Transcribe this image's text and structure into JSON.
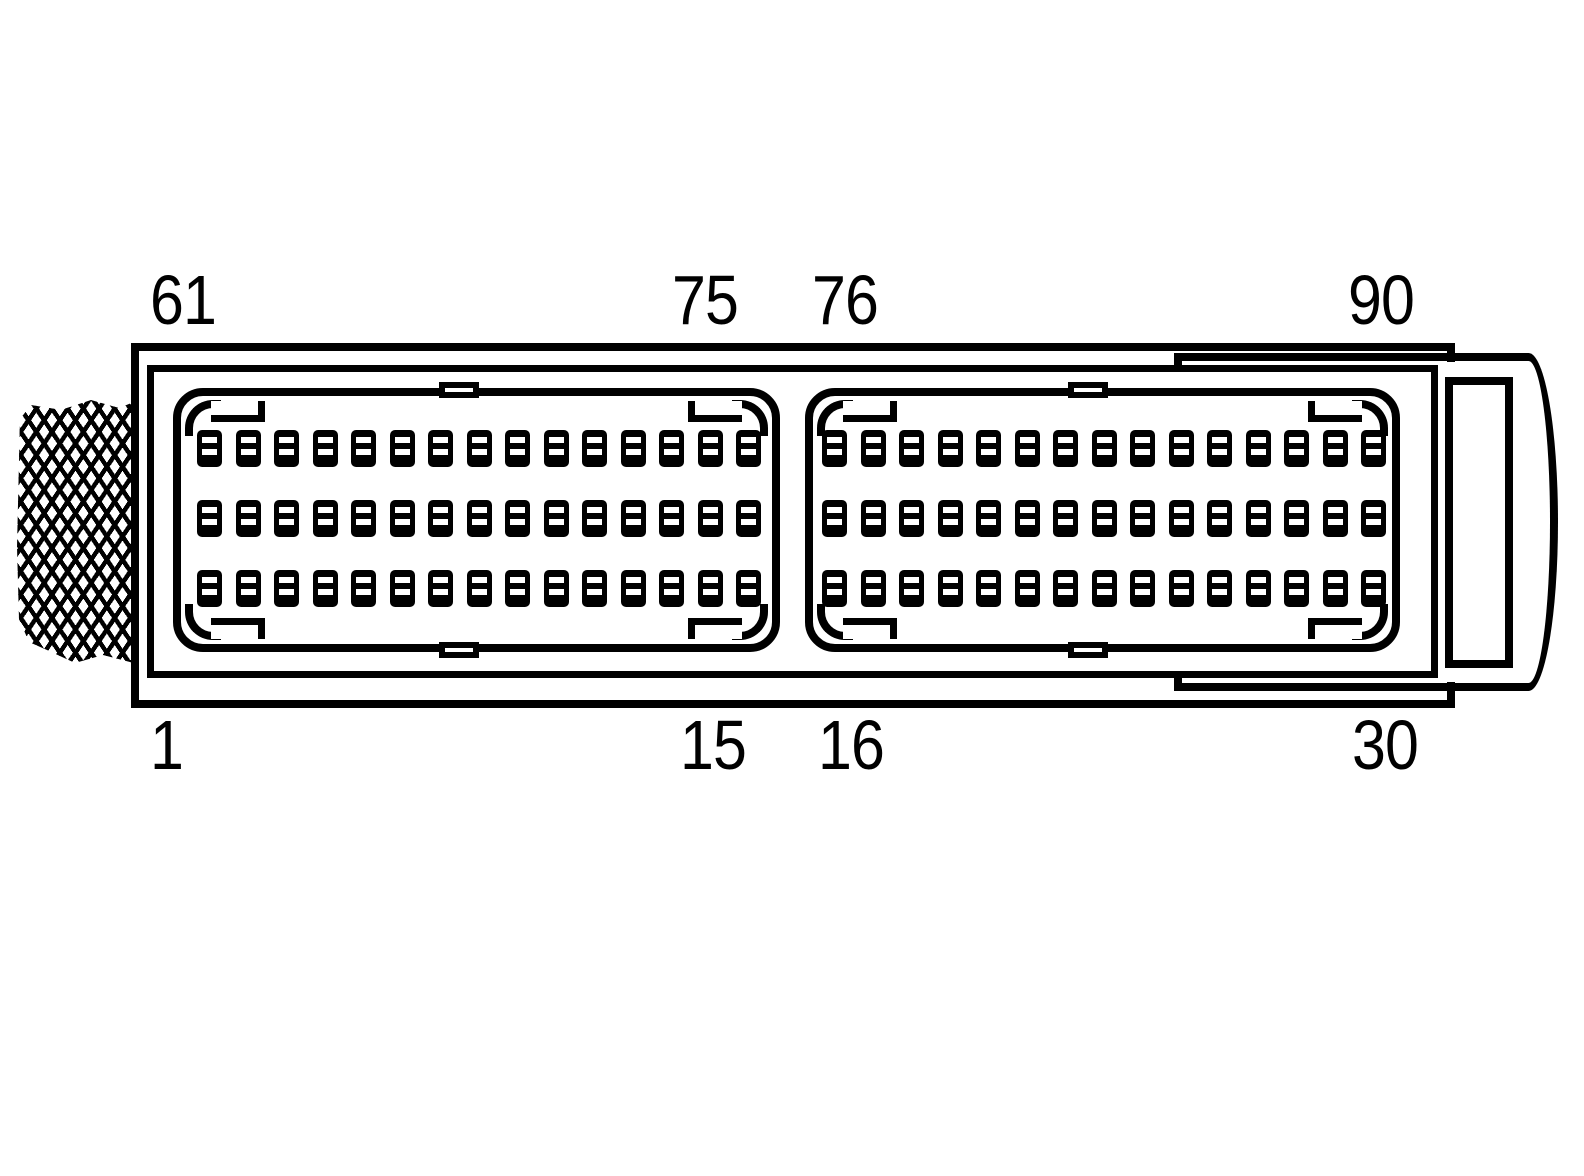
{
  "connector": {
    "labels": [
      {
        "name": "pin-label-61",
        "text": "61",
        "pos": "top-left"
      },
      {
        "name": "pin-label-75",
        "text": "75",
        "pos": "top-mid-left"
      },
      {
        "name": "pin-label-76",
        "text": "76",
        "pos": "top-mid-right"
      },
      {
        "name": "pin-label-90",
        "text": "90",
        "pos": "top-right"
      },
      {
        "name": "pin-label-1",
        "text": "1",
        "pos": "bottom-left"
      },
      {
        "name": "pin-label-15",
        "text": "15",
        "pos": "bottom-mid-left"
      },
      {
        "name": "pin-label-16",
        "text": "16",
        "pos": "bottom-mid-right"
      },
      {
        "name": "pin-label-30",
        "text": "30",
        "pos": "bottom-right"
      }
    ],
    "blocks": [
      {
        "name": "pin-block-1",
        "rows": 3,
        "cols": 15
      },
      {
        "name": "pin-block-2",
        "rows": 3,
        "cols": 15
      }
    ],
    "total_pins": 90,
    "colors": {
      "line": "#000000",
      "background": "#ffffff"
    }
  }
}
